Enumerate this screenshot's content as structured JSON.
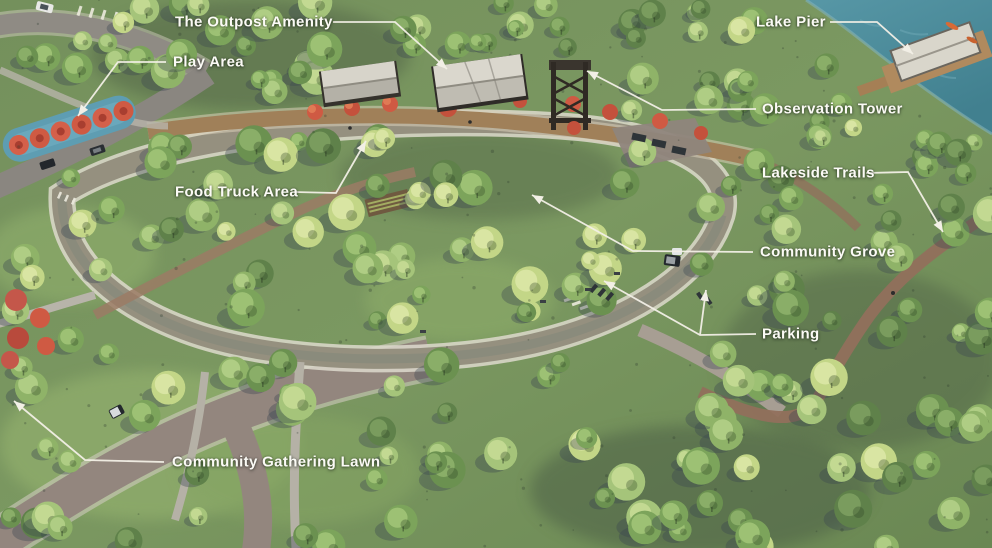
{
  "scene": {
    "description": "Aerial rendering of a community park master plan with labeled amenities",
    "setting": "park with circular loop trail, central tree grove, lakeside at upper right"
  },
  "labels": [
    {
      "id": "the-outpost-amenity",
      "text": "The Outpost Amenity"
    },
    {
      "id": "play-area",
      "text": "Play Area"
    },
    {
      "id": "lake-pier",
      "text": "Lake Pier"
    },
    {
      "id": "observation-tower",
      "text": "Observation Tower"
    },
    {
      "id": "food-truck-area",
      "text": "Food Truck Area"
    },
    {
      "id": "lakeside-trails",
      "text": "Lakeside Trails"
    },
    {
      "id": "community-grove",
      "text": "Community Grove"
    },
    {
      "id": "parking",
      "text": "Parking"
    },
    {
      "id": "community-gathering-lawn",
      "text": "Community Gathering Lawn"
    }
  ],
  "colors": {
    "label_text": "#fbfaf5",
    "leader_line": "#f2efe6",
    "lake_water": "#4d8d9d",
    "canopy_light": "#a9c77d",
    "canopy_yellow": "#c9d98b",
    "canopy_dark": "#5f814a",
    "shadow_slate": "#3c4550",
    "loop_road": "#95907f",
    "outer_road": "#93867e",
    "trail_dirt": "#91705c",
    "promenade": "#a08059",
    "accent_red": "#cf5a43",
    "playground_blue": "#5e9db2",
    "roof_gray": "#d9d6cb"
  }
}
